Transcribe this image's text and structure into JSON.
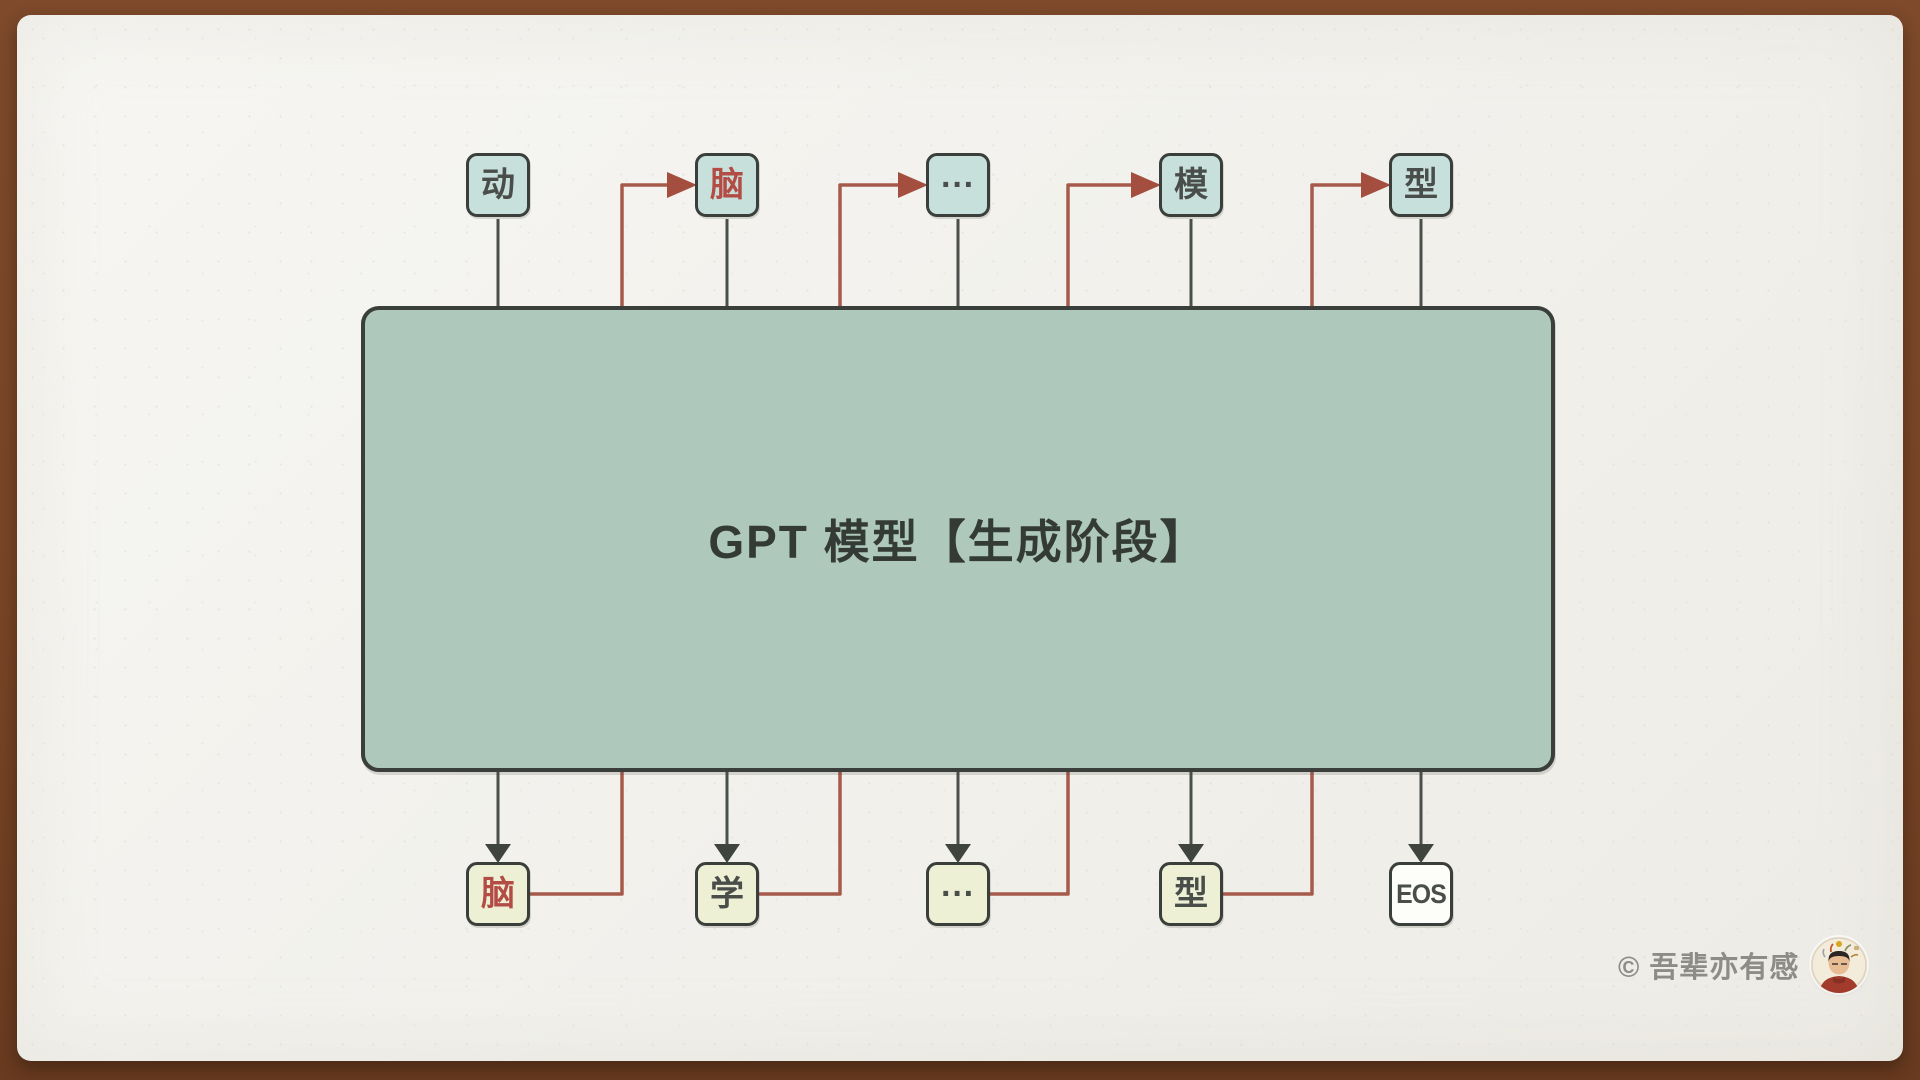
{
  "title": "GPT 模型【生成阶段】",
  "top_row": {
    "tokens": [
      {
        "label": "动",
        "color": "dark"
      },
      {
        "label": "脑",
        "color": "red"
      },
      {
        "label": "···",
        "color": "dark"
      },
      {
        "label": "模",
        "color": "dark"
      },
      {
        "label": "型",
        "color": "dark"
      }
    ]
  },
  "bottom_row": {
    "tokens": [
      {
        "label": "脑",
        "color": "red",
        "variant": "output"
      },
      {
        "label": "学",
        "color": "dark",
        "variant": "output"
      },
      {
        "label": "···",
        "color": "dark",
        "variant": "output"
      },
      {
        "label": "型",
        "color": "dark",
        "variant": "output"
      },
      {
        "label": "EOS",
        "color": "dark",
        "variant": "eos"
      }
    ]
  },
  "watermark": {
    "copyright": "© 吾辈亦有感"
  },
  "colors": {
    "frame_brown": "#7a4527",
    "paper": "#f2f1ec",
    "model_box_fill": "#aec8bb",
    "box_border": "#3a3f3b",
    "input_box_fill": "#c8e0dc",
    "output_box_fill": "#edf0d5",
    "eos_box_fill": "#fdfdf9",
    "dark_line": "#4b4f4b",
    "dark_arrow": "#3f443f",
    "red_line": "#a65a4b",
    "red_arrow": "#a34e3f",
    "red_text": "#b44c46",
    "dark_text": "#4a4e4a",
    "title_text": "#343a35",
    "watermark_text": "#8e8c86"
  }
}
